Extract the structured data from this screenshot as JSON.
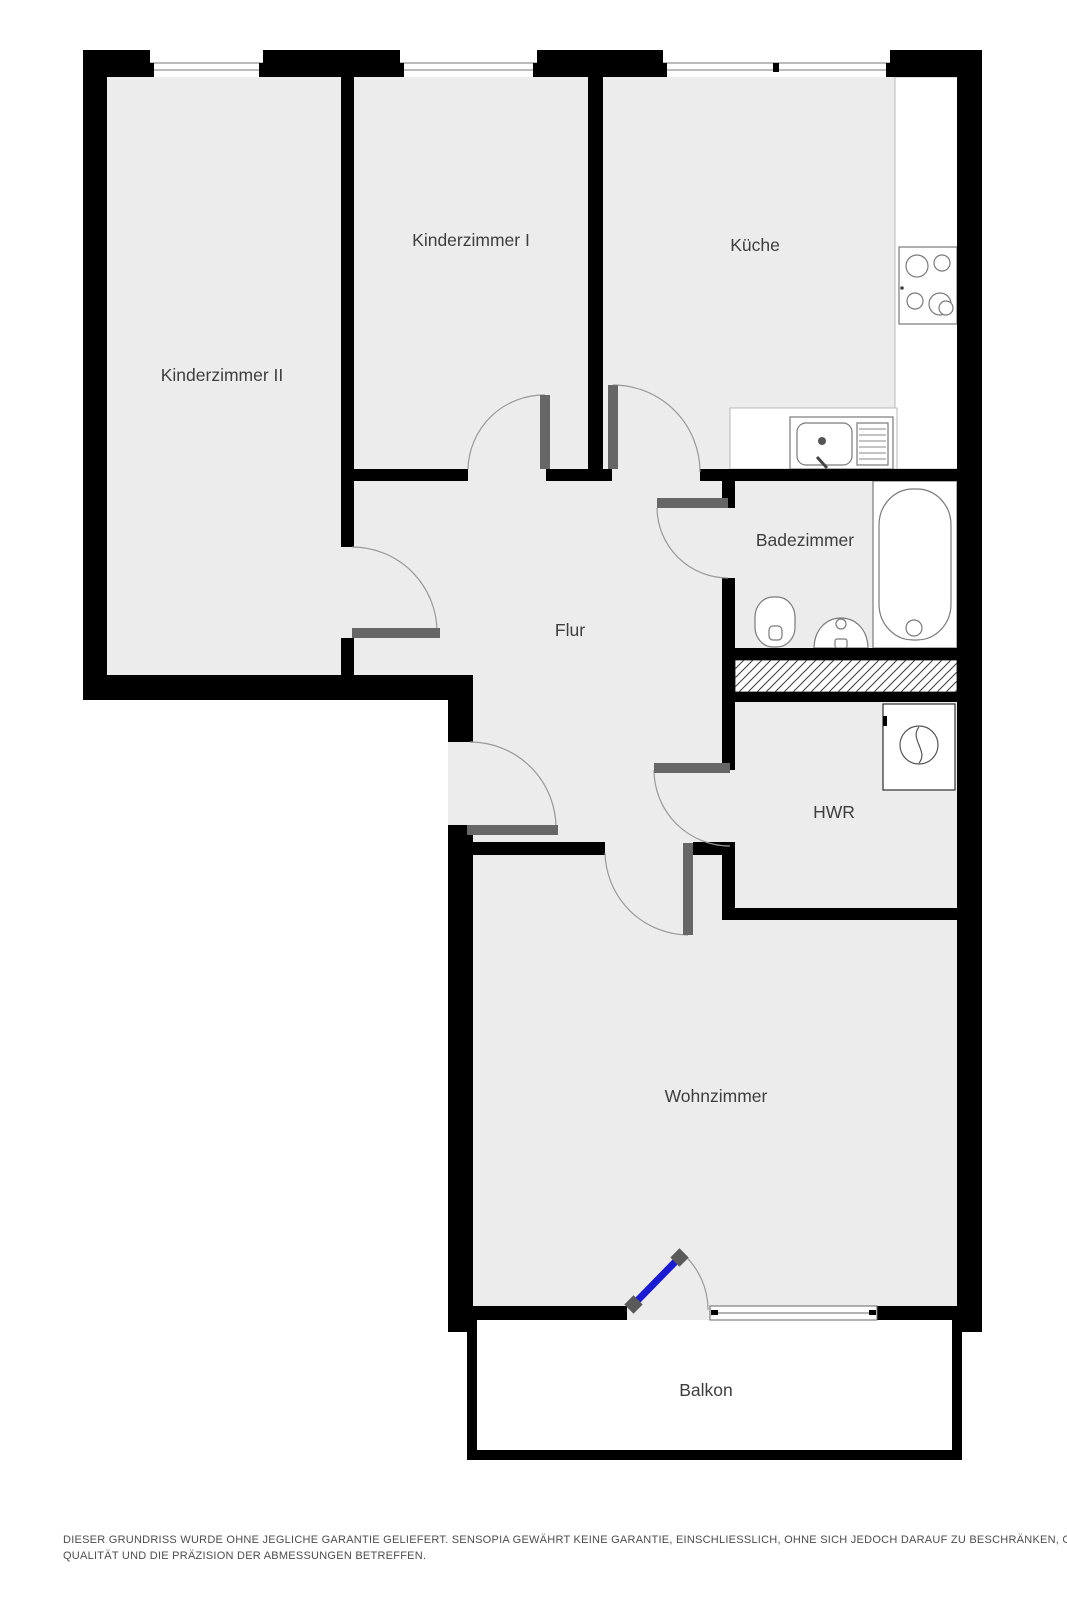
{
  "rooms": [
    {
      "label": "Kinderzimmer II"
    },
    {
      "label": "Kinderzimmer I"
    },
    {
      "label": "Küche"
    },
    {
      "label": "Badezimmer"
    },
    {
      "label": "Flur"
    },
    {
      "label": "HWR"
    },
    {
      "label": "Wohnzimmer"
    },
    {
      "label": "Balkon"
    }
  ],
  "disclaimer": {
    "line1": "DIESER GRUNDRISS WURDE OHNE JEGLICHE GARANTIE GELIEFERT. SENSOPIA GEWÄHRT KEINE GARANTIE, EINSCHLIESSLICH, OHNE SICH JEDOCH DARAUF ZU BESCHRÄNKEN, GARANTIEN, DIE DIE",
    "line2": "QUALITÄT UND DIE PRÄZISION DER ABMESSUNGEN BETREFFEN."
  },
  "colors": {
    "wall": "#000000",
    "room_fill": "#ececec",
    "door_leaf": "#666666",
    "door_swing": "#999999",
    "balcony_door": "#1b1bd3",
    "fixture_stroke": "#7a7a7a",
    "label_text": "#3e3e3e",
    "disclaimer_text": "#4d4d4d"
  }
}
